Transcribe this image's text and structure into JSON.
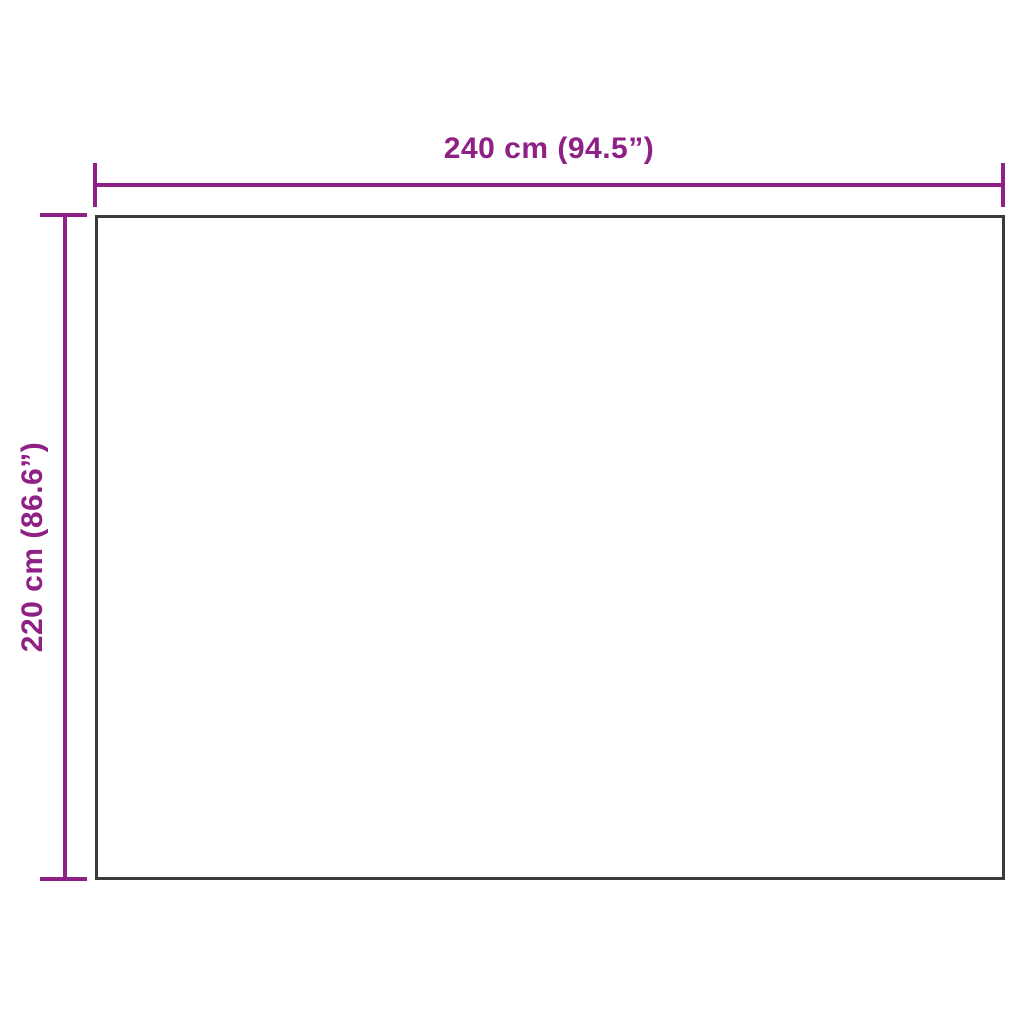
{
  "diagram": {
    "type": "product-dimension-diagram",
    "width_label": "240 cm (94.5”)",
    "height_label": "220 cm (86.6”)",
    "width_value_cm": 240,
    "width_value_inches": 94.5,
    "height_value_cm": 220,
    "height_value_inches": 86.6,
    "accent_color": "#8e2086",
    "outline_color": "#3b3b3b",
    "background_color": "#ffffff"
  }
}
